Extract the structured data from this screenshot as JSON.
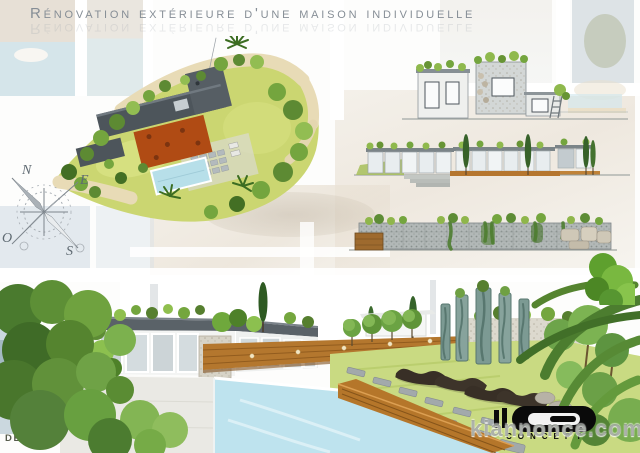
{
  "title": "Rénovation extérieure d'une maison individuelle",
  "credit": "Dessinateur : Florent MAINGUY",
  "watermark": "kiannonce.com",
  "logo_text": "CONCEPT",
  "compass": {
    "north": "N",
    "east": "E",
    "south": "S",
    "west": "O"
  },
  "icons": {
    "compass": "compass-rose",
    "logo_mark": "d-monogram",
    "palms": "palm-tree-icon"
  },
  "colors": {
    "title_gray": "#868e96",
    "plan_lawn": "#cbd671",
    "plan_roof": "#4d555b",
    "plan_terrace": "#b04b14",
    "plan_pool": "#b7dfe9",
    "plan_path": "#e8dbb6",
    "foliage_dark": "#4a7a2e",
    "foliage_light": "#8cb44e",
    "wood_deck": "#b5782e",
    "pool_water": "#bee3ee",
    "stone_gray": "#d3d7d6",
    "logo_black": "#0a0a0a"
  }
}
